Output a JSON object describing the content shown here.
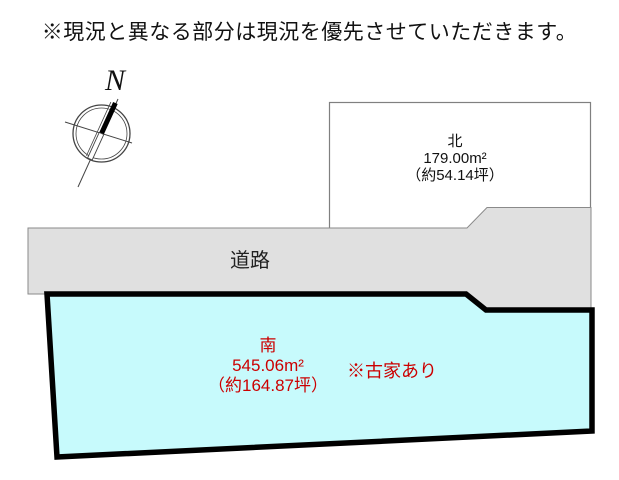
{
  "page": {
    "title": "※現況と異なる部分は現況を優先させていただきます。"
  },
  "compass": {
    "label": "N"
  },
  "plots": {
    "north": {
      "name": "北",
      "area_m2": "179.00m²",
      "area_tsubo": "（約54.14坪）"
    },
    "south": {
      "name": "南",
      "area_m2": "545.06m²",
      "area_tsubo": "（約164.87坪）",
      "note": "※古家あり"
    }
  },
  "road": {
    "label": "道路"
  },
  "colors": {
    "south_plot_fill": "#c7fafc",
    "road_fill": "#e0e0e0",
    "plot_outline_gray": "#808080",
    "south_outline_black": "#000000",
    "label_red": "#cc0000"
  }
}
